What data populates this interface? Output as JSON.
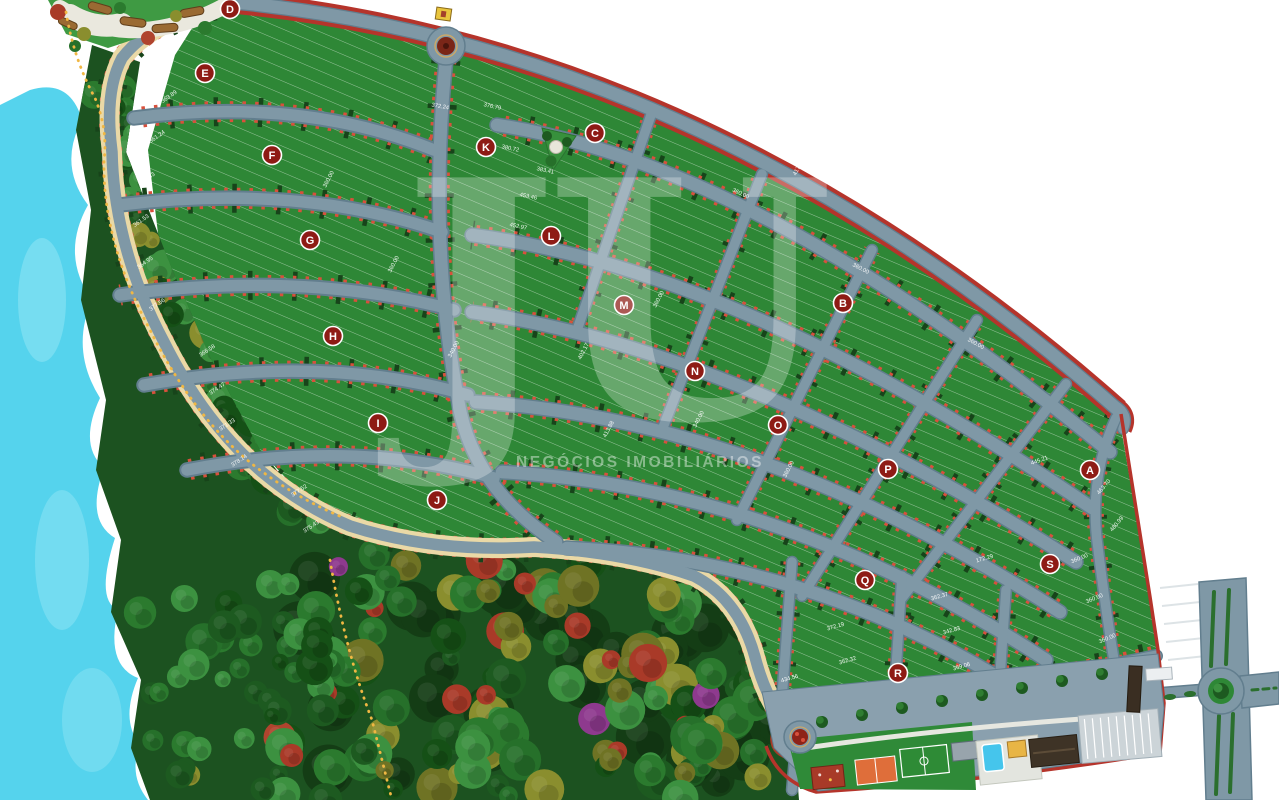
{
  "watermark": {
    "monogram": "JU",
    "subtitle": "NEGÓCIOS IMOBILIÁRIOS"
  },
  "blocks": [
    {
      "label": "A",
      "x": 1090,
      "y": 470
    },
    {
      "label": "B",
      "x": 843,
      "y": 303
    },
    {
      "label": "C",
      "x": 595,
      "y": 133
    },
    {
      "label": "D",
      "x": 230,
      "y": 9
    },
    {
      "label": "E",
      "x": 205,
      "y": 73
    },
    {
      "label": "F",
      "x": 272,
      "y": 155
    },
    {
      "label": "G",
      "x": 310,
      "y": 240
    },
    {
      "label": "H",
      "x": 333,
      "y": 336
    },
    {
      "label": "I",
      "x": 378,
      "y": 423
    },
    {
      "label": "J",
      "x": 437,
      "y": 500
    },
    {
      "label": "K",
      "x": 486,
      "y": 147
    },
    {
      "label": "L",
      "x": 551,
      "y": 236
    },
    {
      "label": "M",
      "x": 624,
      "y": 305
    },
    {
      "label": "N",
      "x": 695,
      "y": 371
    },
    {
      "label": "O",
      "x": 778,
      "y": 425
    },
    {
      "label": "P",
      "x": 888,
      "y": 469
    },
    {
      "label": "Q",
      "x": 865,
      "y": 580
    },
    {
      "label": "R",
      "x": 898,
      "y": 673
    },
    {
      "label": "S",
      "x": 1050,
      "y": 564
    }
  ],
  "lot_labels": [
    {
      "t": "363.89",
      "x": 170,
      "y": 98,
      "r": -35
    },
    {
      "t": "361.24",
      "x": 158,
      "y": 138,
      "r": -35
    },
    {
      "t": "374.43",
      "x": 148,
      "y": 180,
      "r": -35
    },
    {
      "t": "361.53",
      "x": 142,
      "y": 222,
      "r": -35
    },
    {
      "t": "364.95",
      "x": 146,
      "y": 264,
      "r": -35
    },
    {
      "t": "377.56",
      "x": 158,
      "y": 306,
      "r": -35
    },
    {
      "t": "366.58",
      "x": 208,
      "y": 352,
      "r": -33
    },
    {
      "t": "374.47",
      "x": 218,
      "y": 390,
      "r": -33
    },
    {
      "t": "371.33",
      "x": 228,
      "y": 426,
      "r": -33
    },
    {
      "t": "378.14",
      "x": 240,
      "y": 462,
      "r": -33
    },
    {
      "t": "377.52",
      "x": 300,
      "y": 492,
      "r": -33
    },
    {
      "t": "375.43",
      "x": 312,
      "y": 528,
      "r": -33
    },
    {
      "t": "360.00",
      "x": 330,
      "y": 180,
      "r": -62
    },
    {
      "t": "360.00",
      "x": 395,
      "y": 265,
      "r": -62
    },
    {
      "t": "340.00",
      "x": 455,
      "y": 350,
      "r": -62
    },
    {
      "t": "402.17",
      "x": 585,
      "y": 352,
      "r": -62
    },
    {
      "t": "413.88",
      "x": 610,
      "y": 430,
      "r": -62
    },
    {
      "t": "360.00",
      "x": 660,
      "y": 300,
      "r": -62
    },
    {
      "t": "340.00",
      "x": 700,
      "y": 420,
      "r": -62
    },
    {
      "t": "360.00",
      "x": 790,
      "y": 470,
      "r": -62
    },
    {
      "t": "417.87",
      "x": 800,
      "y": 168,
      "r": -62
    },
    {
      "t": "372.24",
      "x": 440,
      "y": 108,
      "r": 10
    },
    {
      "t": "376.79",
      "x": 492,
      "y": 108,
      "r": 12
    },
    {
      "t": "380.72",
      "x": 510,
      "y": 150,
      "r": 12
    },
    {
      "t": "383.41",
      "x": 545,
      "y": 172,
      "r": 12
    },
    {
      "t": "453.46",
      "x": 528,
      "y": 198,
      "r": 12
    },
    {
      "t": "452.97",
      "x": 518,
      "y": 228,
      "r": 12
    },
    {
      "t": "360.00",
      "x": 740,
      "y": 195,
      "r": 25
    },
    {
      "t": "360.00",
      "x": 860,
      "y": 270,
      "r": 27
    },
    {
      "t": "360.00",
      "x": 975,
      "y": 345,
      "r": 29
    },
    {
      "t": "445.21",
      "x": 1040,
      "y": 462,
      "r": -20
    },
    {
      "t": "463.70",
      "x": 1105,
      "y": 488,
      "r": -50
    },
    {
      "t": "480.99",
      "x": 1118,
      "y": 525,
      "r": -50
    },
    {
      "t": "360.00",
      "x": 1080,
      "y": 560,
      "r": -22
    },
    {
      "t": "360.00",
      "x": 1095,
      "y": 600,
      "r": -22
    },
    {
      "t": "360.00",
      "x": 1108,
      "y": 640,
      "r": -22
    },
    {
      "t": "172.29",
      "x": 985,
      "y": 560,
      "r": -16
    },
    {
      "t": "362.37",
      "x": 940,
      "y": 598,
      "r": -16
    },
    {
      "t": "342.83",
      "x": 952,
      "y": 632,
      "r": -16
    },
    {
      "t": "369.06",
      "x": 962,
      "y": 668,
      "r": -16
    },
    {
      "t": "372.19",
      "x": 836,
      "y": 628,
      "r": -16
    },
    {
      "t": "362.32",
      "x": 848,
      "y": 662,
      "r": -16
    },
    {
      "t": "434.56",
      "x": 790,
      "y": 680,
      "r": -16
    }
  ],
  "colors": {
    "road": "#7f98a6",
    "lot_green": "#2e8736",
    "water": "#55d3ed",
    "forest": "#1c5220",
    "boundary_red": "#b5342b",
    "badge_red": "#8e1b15",
    "lot_marker_red": "#d8503c",
    "path_beige": "#ead9a6",
    "pool_blue": "#45c5ec",
    "court_orange": "#df6e3a",
    "building_yellow": "#e8b545",
    "trail_yellow": "#f0b743"
  }
}
